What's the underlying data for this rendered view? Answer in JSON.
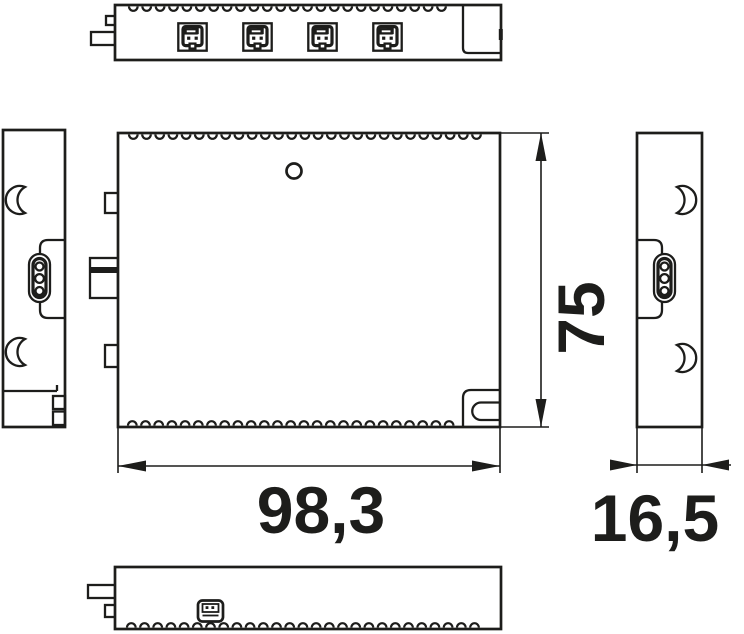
{
  "drawing": {
    "background": "#ffffff",
    "line_color": "#1d1d1b",
    "dimensions": {
      "width": {
        "label": "98,3",
        "value": 98.3
      },
      "height": {
        "label": "75",
        "value": 75
      },
      "depth": {
        "label": "16,5",
        "value": 16.5
      }
    },
    "views": {
      "top": {
        "name": "top-view",
        "connector_ports": 4,
        "vent_slots": 24
      },
      "front": {
        "name": "front-view",
        "vent_slots_top": 27,
        "vent_slots_bottom": 25,
        "mounting_holes": 1
      },
      "left": {
        "name": "left-side-view",
        "pin_connector_pins": 3,
        "snap_hooks": 2
      },
      "right": {
        "name": "right-side-view",
        "pin_connector_pins": 3,
        "snap_hooks": 2
      },
      "bottom": {
        "name": "bottom-view",
        "vent_slots": 27,
        "ports": 1
      }
    }
  }
}
